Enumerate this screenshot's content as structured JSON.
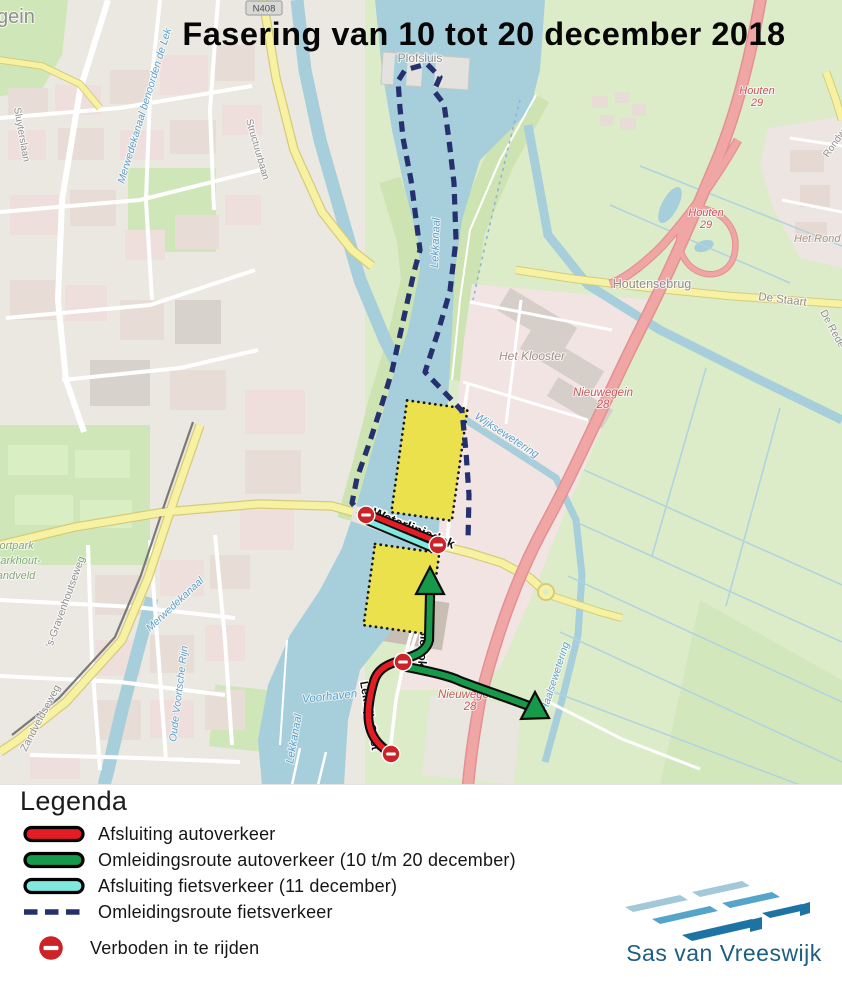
{
  "title": "Fasering van 10 tot 20 december 2018",
  "map": {
    "labels": {
      "nieuwegein_partial": "gein",
      "road_ref_n408": "N408",
      "structuurbaan": "Structuurbaan",
      "sluyterslaan": "Sluyterslaan",
      "merwedekanaal_noord": "Merwedekanaal benoorden de Lek",
      "plofsluis": "Plofsluis",
      "houten": "Houten",
      "ref_29": "29",
      "rondweg": "Rondweg",
      "het_rond": "Het Rond",
      "houtensebrug": "Houtensebrug",
      "de_staart": "De Staart",
      "de_rede": "De Rede",
      "het_klooster": "Het Klooster",
      "nieuwegein": "Nieuwegein",
      "ref_28": "28",
      "wijksewetering": "Wijksewetering",
      "inundatiedok": "Inundatiedok",
      "waterliniedok": "Waterliniedok",
      "defensiedok": "Defensiedok",
      "lekdijk_oost": "Lekdijk-Oost",
      "lekkanaal": "Lekkanaal",
      "voorhaven": "Voorhaven",
      "haalsewetering": "Haalsewetering",
      "s_gravenhoutseweg": "'s-Gravenhoutseweg",
      "zandveldseweg": "Zandveldseweg",
      "sportpark_line1": "Sportpark",
      "sportpark_line2": "Parkhout-",
      "sportpark_line3": "Zandveld",
      "merwedekanaal_zuid": "Merwedekanaal",
      "oude_voortsche_rijn": "Oude Voortsche Rijn"
    }
  },
  "legend": {
    "title": "Legenda",
    "items": [
      {
        "label": "Afsluiting autoverkeer",
        "swatch": "line-red"
      },
      {
        "label": "Omleidingsroute autoverkeer (10 t/m 20 december)",
        "swatch": "line-green"
      },
      {
        "label": "Afsluiting fietsverkeer (11 december)",
        "swatch": "line-cyan"
      },
      {
        "label": "Omleidingsroute fietsverkeer",
        "swatch": "line-dashed-navy"
      },
      {
        "label": "Verboden in te rijden",
        "swatch": "no-entry-sign"
      }
    ]
  },
  "logo": {
    "name": "Sas van Vreeswijk"
  },
  "colors": {
    "closure_car": "#e31d23",
    "detour_car": "#17994a",
    "closure_bike": "#7fe9df",
    "detour_bike": "#25306e",
    "no_entry": "#cb2328",
    "work_zone": "#ebe14d",
    "logo_text": "#1d5f7d",
    "logo_light": "#a3c8d8",
    "logo_mid": "#55a5cb",
    "logo_dark": "#1d74a4"
  }
}
